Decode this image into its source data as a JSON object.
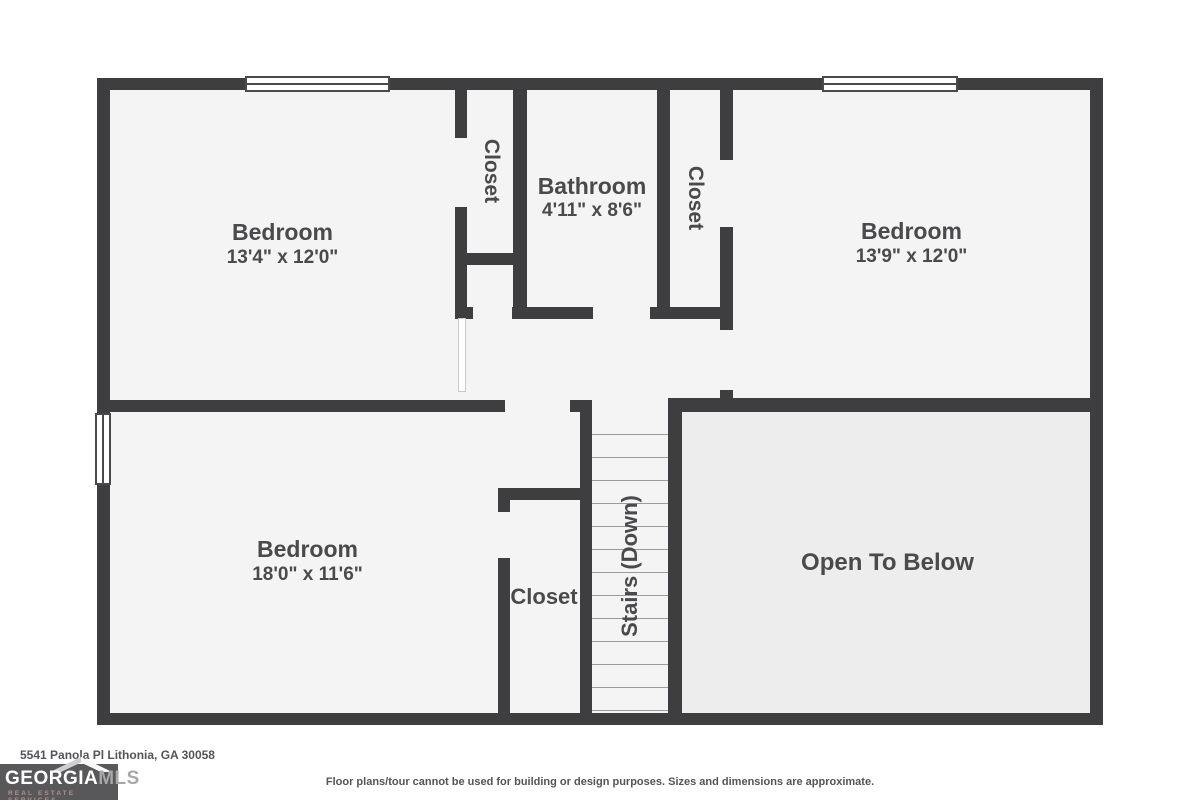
{
  "rooms": {
    "bedroom_tl": {
      "name": "Bedroom",
      "dims": "13'4\" x 12'0\""
    },
    "bathroom": {
      "name": "Bathroom",
      "dims": "4'11\" x 8'6\""
    },
    "bedroom_tr": {
      "name": "Bedroom",
      "dims": "13'9\" x 12'0\""
    },
    "bedroom_bl": {
      "name": "Bedroom",
      "dims": "18'0\" x 11'6\""
    },
    "closet_left": {
      "name": "Closet"
    },
    "closet_right": {
      "name": "Closet"
    },
    "closet_bottom": {
      "name": "Closet"
    },
    "stairs": {
      "name": "Stairs (Down)"
    },
    "open_to_below": {
      "name": "Open To Below"
    }
  },
  "footer": {
    "address": "5541 Panola Pl Lithonia, GA 30058",
    "disclaimer": "Floor plans/tour cannot be used for building or design purposes. Sizes and dimensions are approximate."
  },
  "logo": {
    "name_primary": "GEORGIA",
    "name_secondary": "MLS",
    "tagline": "REAL ESTATE SERVICES"
  },
  "colors": {
    "wall": "#3e3e40",
    "room_fill": "#f4f4f4",
    "open_area_fill": "#ededed",
    "label_text": "#4a4a4c",
    "logo_bg": "#58585a"
  }
}
